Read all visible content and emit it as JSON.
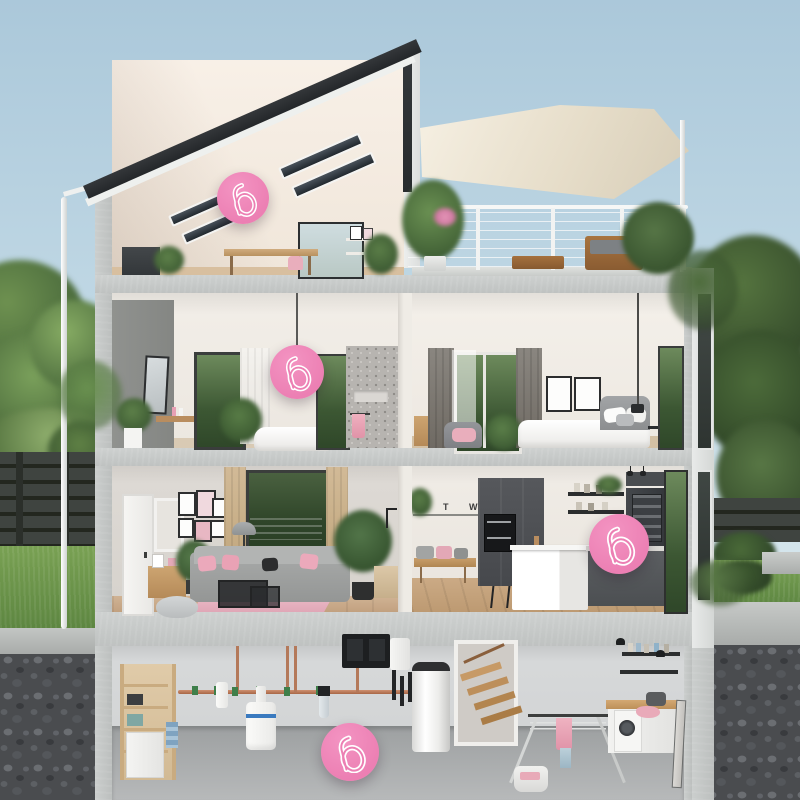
{
  "scene": {
    "type": "interactive-house-cutaway-diagram",
    "description": "Photoreal cutaway of a four-storey house (attic studio with roof terrace, bathroom and bedroom floor, living room and kitchen floor, basement utility/laundry) with round pink product hotspots",
    "width": 800,
    "height": 800
  },
  "brand": {
    "accent_color": "#ec7fb3",
    "logo_glyph": "b"
  },
  "decor": {
    "kitchen_wall_letters": "B T W"
  },
  "hotspots": [
    {
      "id": "attic-studio",
      "x": 243,
      "y": 198,
      "size": 52
    },
    {
      "id": "bathroom",
      "x": 297,
      "y": 372,
      "size": 54
    },
    {
      "id": "kitchen",
      "x": 619,
      "y": 544,
      "size": 60
    },
    {
      "id": "basement-laundry",
      "x": 350,
      "y": 752,
      "size": 58
    }
  ],
  "rooms": [
    {
      "id": "attic-studio"
    },
    {
      "id": "roof-terrace"
    },
    {
      "id": "bathroom"
    },
    {
      "id": "bedroom"
    },
    {
      "id": "living-room"
    },
    {
      "id": "kitchen"
    },
    {
      "id": "basement-utility"
    },
    {
      "id": "basement-laundry"
    }
  ],
  "palette": {
    "sky_top": "#abc8da",
    "sky_bottom": "#d9e8ee",
    "concrete": "#c7cac9",
    "interior_wall": "#f2eee8",
    "roof": "#2d3032",
    "grass": "#6f9a4d",
    "foliage_dark": "#3e5a31",
    "foliage_light": "#6e9150",
    "gravel": "#4a4c4f",
    "wood_floor": "#c8ab8d",
    "pink_textile": "#eba9bb",
    "sail": "#efe8da"
  }
}
